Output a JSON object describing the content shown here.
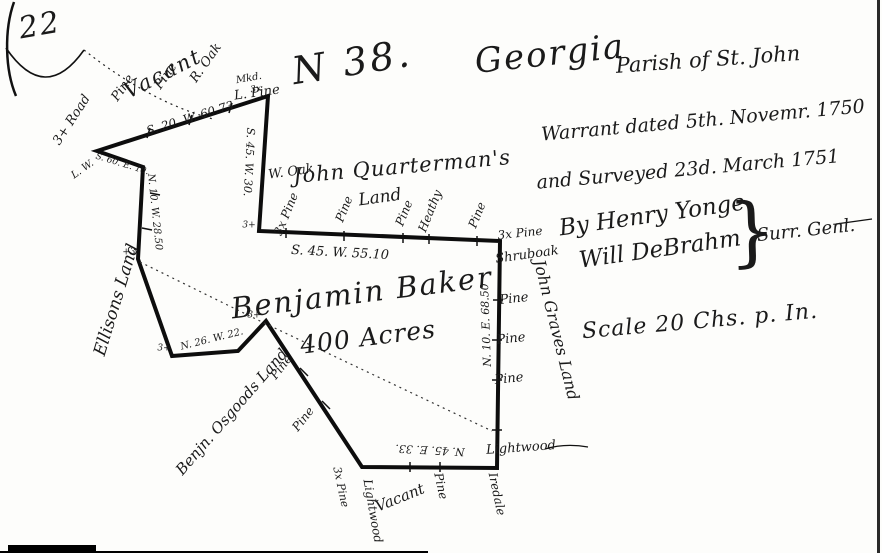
{
  "document": {
    "page_number": "22",
    "plat_number": "N 38.",
    "colony": "Georgia",
    "parish": "Parish of St. John",
    "warrant_line": "Warrant dated 5th. Novemr. 1750",
    "surveyed_line": "and Surveyed 23d. March 1751",
    "surveyor_by": "By Henry Yonge",
    "surveyor_second": "Will DeBrahm",
    "surveyor_brace": "}",
    "surveyor_title": "Surr. Genl.",
    "scale_note": "Scale 20 Chs. p. In."
  },
  "parcel": {
    "owner": "Benjamin Baker",
    "acreage": "400 Acres"
  },
  "adjoining": {
    "north": "Vacant",
    "northeast_owner": "John Quarterman's",
    "northeast_owner_2": "Land",
    "west": "Ellisons Land",
    "southwest": "Benjn. Osgoods Land",
    "east": "John Graves Land",
    "south": "Vacant"
  },
  "bearings": {
    "north_line": "S. 20. W. 60.73",
    "west_upper_line": "S. 45. W. 30.",
    "middle_line": "S. 45. W. 55.10",
    "east_line": "N. 10. E. 68.50",
    "south_line": "N. 45. E. 33.",
    "notch_line": "N. 26. W. 22.",
    "west_lower_line": "N. 10. W. 28.50",
    "jog_line": "S. 60. E. 10."
  },
  "features": {
    "road": "3+ Road",
    "small_note": "L. W.",
    "corner_tree_note": "Mkd.",
    "corner_tree": "L. Pine",
    "west_oak": "W. Oak",
    "corner_marks": [
      "3x",
      "3+",
      "+3",
      "3+",
      "3+"
    ],
    "north_trees": [
      "Pine",
      "Pine",
      "R. Oak"
    ],
    "quarterman_trees": [
      "3x Pine",
      "Pine",
      "Pine",
      "Heathy",
      "Pine"
    ],
    "east_trees": [
      "3x Pine",
      "Shruboak",
      "Pine",
      "Pine",
      "Pine",
      "Lightwood"
    ],
    "diagonal_trees": [
      "Pine",
      "Pine"
    ],
    "south_trees": [
      "3x Pine",
      "Lightwood",
      "Pine",
      "Iredale"
    ]
  }
}
